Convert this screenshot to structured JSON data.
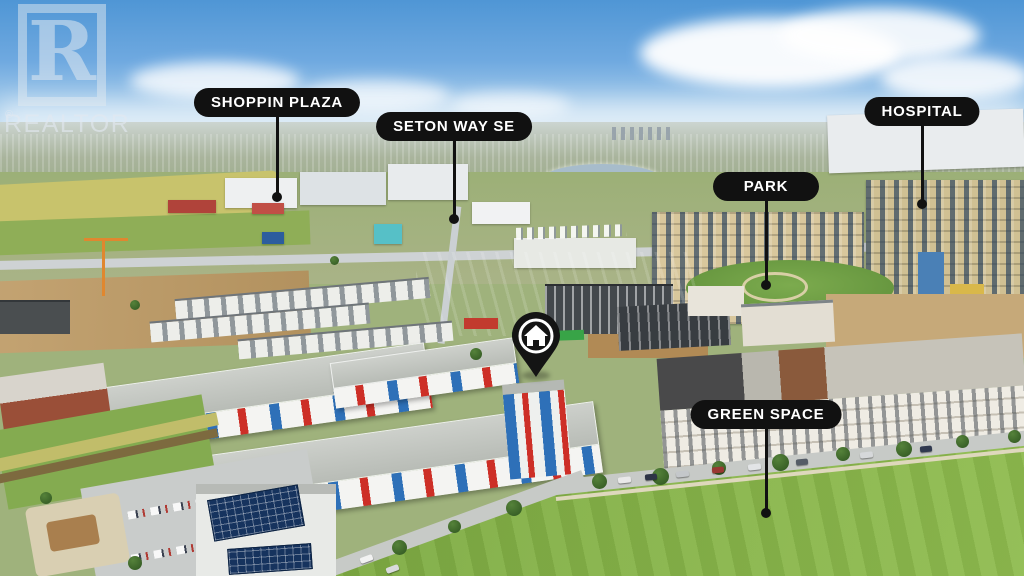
{
  "scene": {
    "labels": [
      {
        "id": "shoppin-plaza",
        "text": "SHOPPIN PLAZA"
      },
      {
        "id": "seton-way-se",
        "text": "SETON WAY SE"
      },
      {
        "id": "park",
        "text": "PARK"
      },
      {
        "id": "hospital",
        "text": "HOSPITAL"
      },
      {
        "id": "green-space",
        "text": "GREEN SPACE"
      }
    ],
    "marker": {
      "icon": "house-icon"
    }
  },
  "watermark": {
    "letter": "R",
    "name": "REALTOR",
    "registered": "®"
  },
  "palette": {
    "label_bg": "#111111",
    "label_text": "#ffffff",
    "sky_top": "#4f96d5",
    "lawn_green": "#84b147",
    "accent_red": "#cd2f27",
    "accent_blue": "#2e70b8",
    "hospital_beige": "#d8c79c",
    "dirt_brown": "#bd9a66",
    "pin_black": "#141414"
  }
}
